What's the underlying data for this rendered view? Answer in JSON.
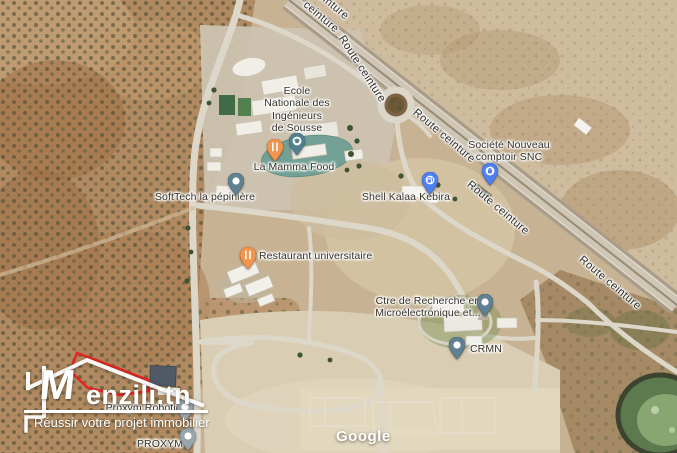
{
  "map": {
    "attribution": "Google",
    "road_labels": [
      "ceinture",
      "ceinture",
      "Route ceinture",
      "Route ceinture",
      "Route ceinture",
      "Route ceinture"
    ],
    "pois": [
      {
        "id": "enis",
        "label": "Ecole\nNationale des\nIngénieurs\nde Sousse",
        "marker": "school",
        "marker_color": "#54808f"
      },
      {
        "id": "la-mamma-food",
        "label": "La Mamma Food",
        "marker": "restaurant",
        "marker_color": "#f2954f"
      },
      {
        "id": "softtech-pepiniere",
        "label": "SoftTech la pépinière",
        "marker": "place",
        "marker_color": "#5f8191"
      },
      {
        "id": "shell-kalaa-kebira",
        "label": "Shell Kalaa Kebira",
        "marker": "gas-station",
        "marker_color": "#4f80f0"
      },
      {
        "id": "societe-nouveau-comptoir-snc",
        "label": "Société Nouveau\ncomptoir SNC",
        "marker": "shopping",
        "marker_color": "#4f80f0"
      },
      {
        "id": "restaurant-universitaire",
        "label": "Restaurant universitaire",
        "marker": "restaurant",
        "marker_color": "#f2954f"
      },
      {
        "id": "ctre-recherche-microelectronique",
        "label": "Ctre de Recherche en\nMicroélectronique et...",
        "marker": "place",
        "marker_color": "#5f8191"
      },
      {
        "id": "crmn",
        "label": "CRMN",
        "marker": "place",
        "marker_color": "#5f8191"
      },
      {
        "id": "proxym-robotics",
        "label": "Proxym Robotics",
        "marker": "place",
        "marker_color": "#97a6ad"
      },
      {
        "id": "proxym",
        "label": "PROXYM",
        "marker": "place",
        "marker_color": "#97a6ad"
      }
    ]
  },
  "watermark": {
    "monogram": "M",
    "brand": "enzili.tn",
    "tagline": "Réussir votre projet immobilier",
    "boundary_color": "#e81f1f"
  }
}
